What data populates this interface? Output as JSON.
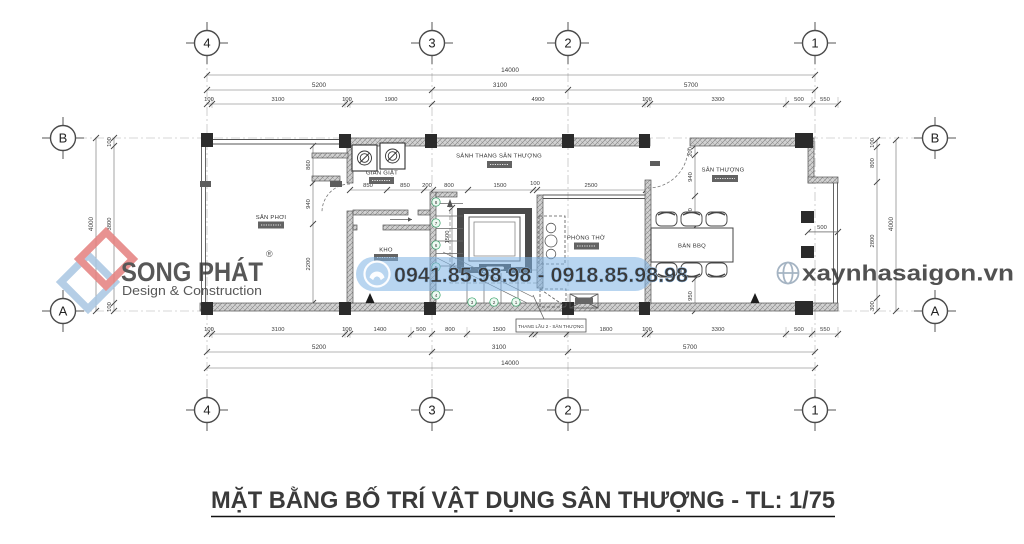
{
  "title": "MẶT BẰNG BỐ TRÍ VẬT DỤNG SÂN THƯỢNG - TL: 1/75",
  "grid": {
    "cols": [
      "4",
      "3",
      "2",
      "1"
    ],
    "rows": [
      "B",
      "A"
    ]
  },
  "dims": {
    "top_total": "14000",
    "top_spans": [
      "5200",
      "3100",
      "5700"
    ],
    "top_detail": [
      "100",
      "3100",
      "100",
      "1900",
      "4900",
      "100",
      "3300",
      "500",
      "550"
    ],
    "bottom_total": "14000",
    "bottom_spans": [
      "5200",
      "3100",
      "5700"
    ],
    "bottom_detail": [
      "100",
      "3100",
      "100",
      "1400",
      "500",
      "800",
      "1500",
      "100",
      "700",
      "1800",
      "100",
      "3300",
      "500",
      "550"
    ],
    "left_total": "4000",
    "left_detail": [
      "100",
      "3800",
      "100"
    ],
    "right_total": "4000",
    "right_detail": [
      "100",
      "800",
      "2800",
      "300"
    ],
    "interior_top": [
      "850",
      "850",
      "200",
      "800",
      "1500",
      "100",
      "2500"
    ],
    "interior_left": [
      "860",
      "940",
      "2200"
    ],
    "interior_right": [
      "200",
      "940",
      "710",
      "1200",
      "950"
    ],
    "stairwell": "1500",
    "bay": "500"
  },
  "rooms": {
    "san_phoi": "SÂN PHƠI",
    "gian_giat": "GIAN GIẶT",
    "kho": "KHO",
    "sanh_thang": "SẢNH THANG SÂN THƯỢNG",
    "phong_tho": "PHÒNG THỜ",
    "san_thuong": "SÂN THƯỢNG",
    "ban_bbq": "BÀN BBQ"
  },
  "callout": "THANG LẦU 2 - SÂN THƯỢNG",
  "stair_treads": [
    "8",
    "7",
    "6",
    "5",
    "4",
    "3",
    "2",
    "1"
  ],
  "watermarks": {
    "phone": "0941.85.98.98 - 0918.85.98.98",
    "website": "xaynhasaigon.vn",
    "logo_name": "SONG PHÁT",
    "logo_reg": "®",
    "logo_sub": "Design & Construction"
  },
  "colors": {
    "phone_band": "#7db3e3",
    "phone_text": "#ffffff",
    "website_text": "#99aabb",
    "logo_blue": "#abd0ee",
    "logo_red": "#e5807e",
    "stair_marker": "#2f9e63"
  }
}
